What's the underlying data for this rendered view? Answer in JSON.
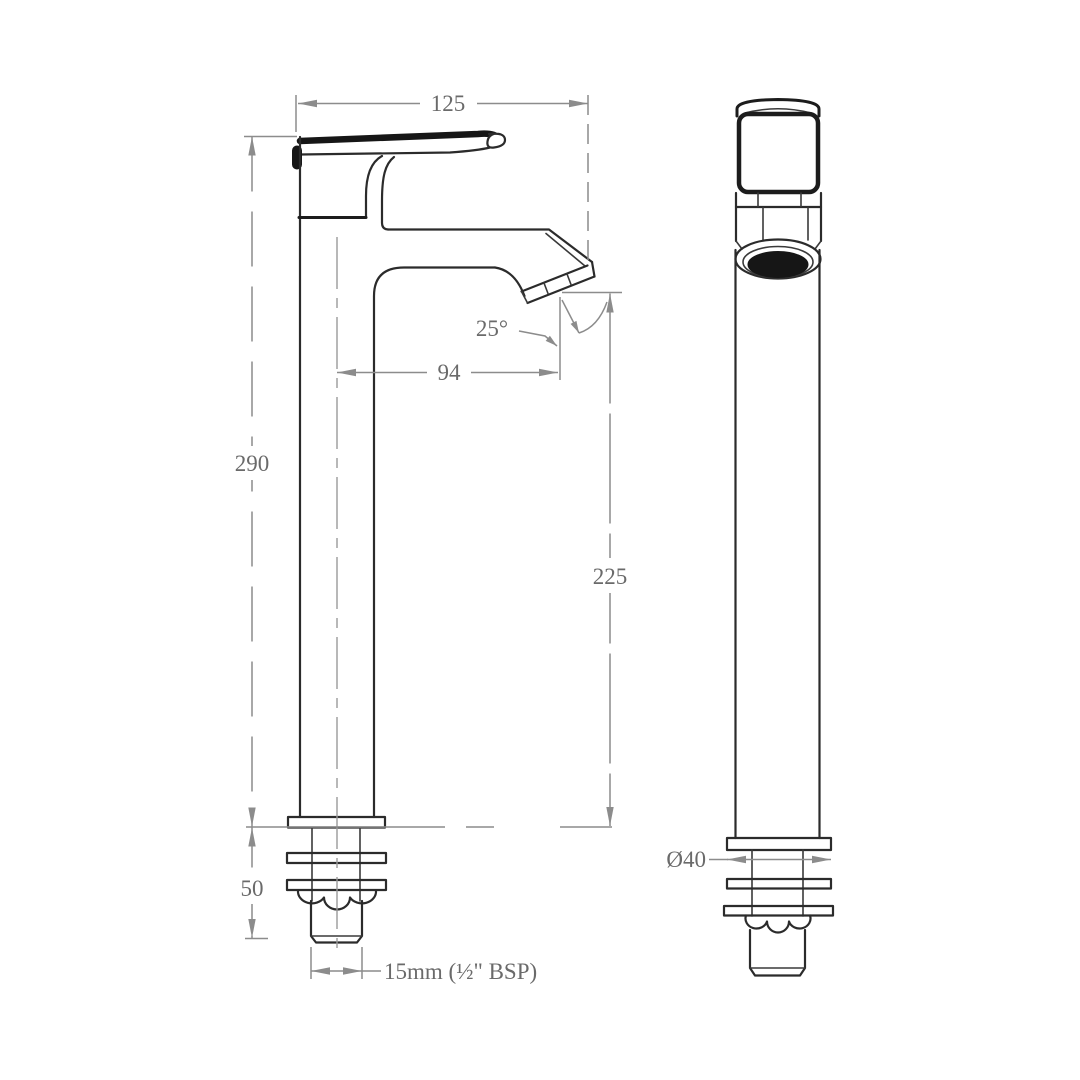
{
  "drawing": {
    "kind": "faucet-technical-dimension-drawing",
    "dimensions": {
      "lever_length": "125",
      "overall_height": "290",
      "spout_reach": "94",
      "outlet_angle": "25°",
      "outlet_height": "225",
      "shank_length": "50",
      "inlet_thread": "15mm (½\" BSP)",
      "base_diameter": "Ø40"
    },
    "colors": {
      "line": "#2b2b2b",
      "dimension_line": "#8c8c8c",
      "dimension_text": "#6a6a6a",
      "background": "#ffffff"
    }
  }
}
